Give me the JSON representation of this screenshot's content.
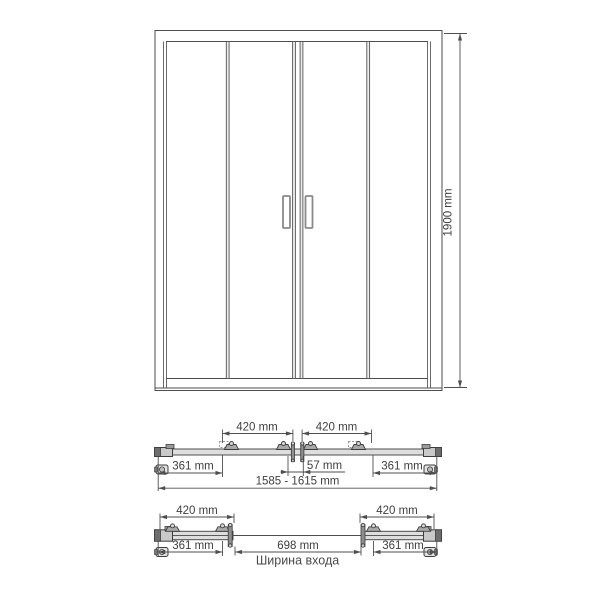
{
  "front_view": {
    "height": "1900 mm"
  },
  "top_view_closed": {
    "panel_left": "420 mm",
    "panel_right": "420 mm",
    "side_left": "361 mm",
    "center_gap": "57 mm",
    "side_right": "361 mm",
    "total_width": "1585 - 1615 mm"
  },
  "top_view_open": {
    "panel_left": "420 mm",
    "panel_right": "420 mm",
    "side_left": "361 mm",
    "entry_width": "698 mm",
    "side_right": "361 mm",
    "entry_caption": "Ширина входа"
  },
  "colors": {
    "line": "#4d4d4d",
    "text": "#3f3f3f",
    "rail_fill": "#dedede",
    "hardware_dark": "#6e6e6e",
    "background": "#ffffff"
  }
}
